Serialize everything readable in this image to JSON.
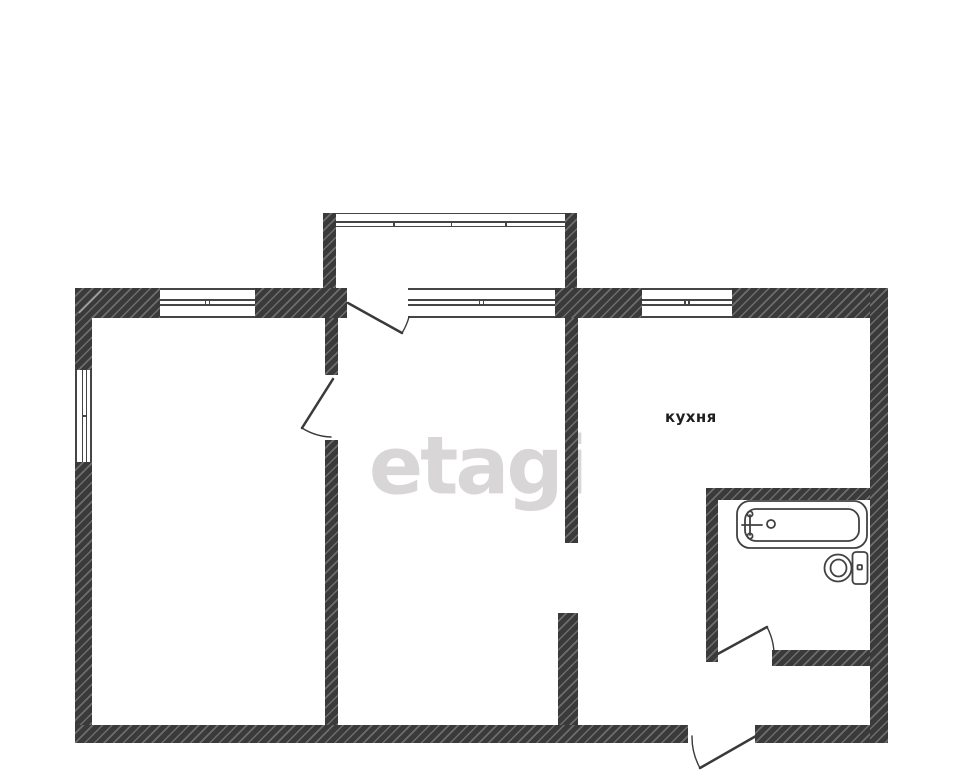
{
  "page": {
    "background": "#ffffff"
  },
  "colors": {
    "wall": "#3b3a3a",
    "line": "#454545",
    "door": "#3a3a3a",
    "label": "#1f1f1f",
    "watermark": "#d2cfcf",
    "background": "#ffffff"
  },
  "labels": {
    "kitchen": "кухня"
  },
  "watermark": {
    "text": "etagi"
  },
  "fixtures": [
    {
      "name": "bathtub"
    },
    {
      "name": "toilet"
    }
  ],
  "doors": [
    {
      "name": "balcony-door"
    },
    {
      "name": "left-room-door"
    },
    {
      "name": "bathroom-door"
    },
    {
      "name": "entrance-door"
    }
  ],
  "windows": [
    {
      "name": "left-room-top-window"
    },
    {
      "name": "left-wall-window"
    },
    {
      "name": "balcony-glazing"
    },
    {
      "name": "under-balcony-window"
    },
    {
      "name": "kitchen-window"
    }
  ]
}
